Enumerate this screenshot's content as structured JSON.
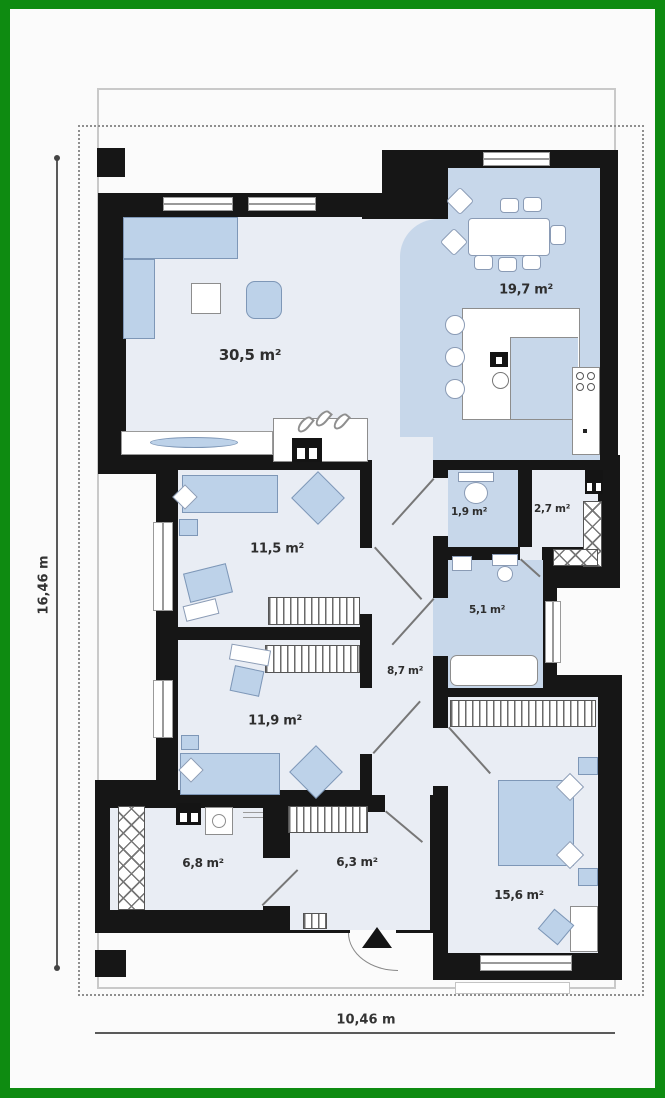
{
  "plan": {
    "title": "single-storey house floor plan",
    "area_labels": {
      "living": "30,5 m²",
      "dining": "19,7 m²",
      "bedroom1": "11,5 m²",
      "wc": "1,9 m²",
      "storage": "2,7 m²",
      "bathroom": "5,1 m²",
      "hallway": "8,7 m²",
      "bedroom2": "11,9 m²",
      "laundry": "6,8 m²",
      "entry": "6,3 m²",
      "bedroom3": "15,6 m²"
    },
    "dimensions": {
      "height": "16,46 m",
      "width": "10,46 m"
    },
    "icons": {
      "entrance_arrow": "up-triangle",
      "fireplace_flames": "three flame glyphs"
    },
    "colors": {
      "frame_green": "#0e8b11",
      "wall_black": "#161616",
      "room_light": "#e9edf4",
      "room_blue": "#c7d7ea",
      "furniture_blue": "#bdd2e9"
    }
  }
}
